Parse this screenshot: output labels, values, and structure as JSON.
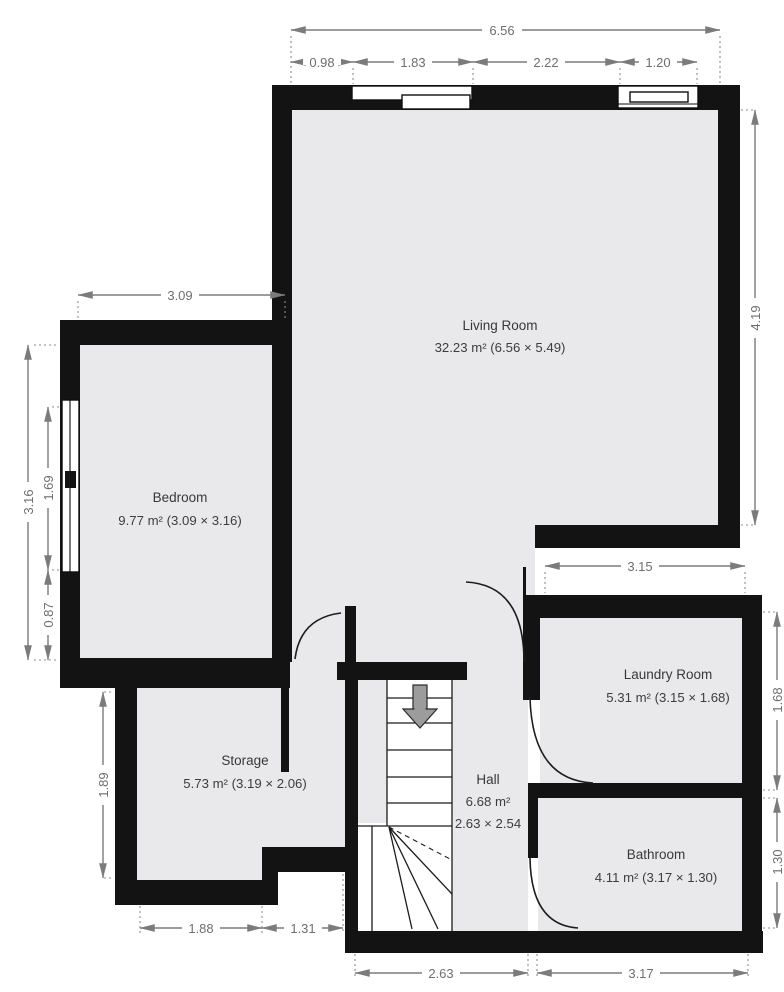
{
  "plan": {
    "rooms": {
      "living": {
        "name": "Living Room",
        "area": "32.23 m² (6.56 × 5.49)"
      },
      "bedroom": {
        "name": "Bedroom",
        "area": "9.77 m² (3.09 × 3.16)"
      },
      "storage": {
        "name": "Storage",
        "area": "5.73 m² (3.19 × 2.06)"
      },
      "hall": {
        "name": "Hall",
        "area": "6.68 m²",
        "dims": "2.63 × 2.54"
      },
      "laundry": {
        "name": "Laundry Room",
        "area": "5.31 m² (3.15 × 1.68)"
      },
      "bathroom": {
        "name": "Bathroom",
        "area": "4.11 m² (3.17 × 1.30)"
      }
    },
    "dimensions": {
      "top_total": "6.56",
      "top_a": "0.98",
      "top_b": "1.83",
      "top_c": "2.22",
      "top_d": "1.20",
      "bedroom_w": "3.09",
      "left_total": "3.16",
      "left_window": "1.69",
      "left_below": "0.87",
      "right_living": "4.19",
      "laundry_w": "3.15",
      "right_laundry": "1.68",
      "right_bath": "1.30",
      "storage_h": "1.89",
      "bottom_storage": "1.88",
      "bottom_notch": "1.31",
      "bottom_hall": "2.63",
      "bottom_bath": "3.17"
    },
    "colors": {
      "floor": "#e9e9eb",
      "wall": "#131313",
      "dimension_gray": "#7b7b7b",
      "label_text": "#3a3a3a"
    }
  }
}
